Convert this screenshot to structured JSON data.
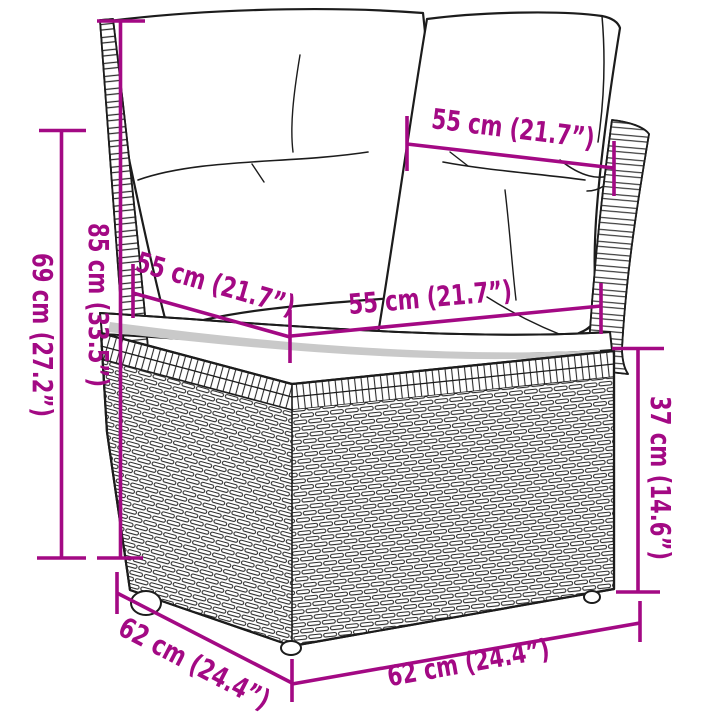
{
  "page": {
    "title": "Corner sofa with cushions — dimension diagram"
  },
  "diagram": {
    "product": "poly-rattan-corner-sofa-section-with-back-cushions",
    "accent_color": "#A30984",
    "outline_color": "#1C1C1C",
    "shadow_color": "#C9C9C9",
    "dimensions": [
      {
        "id": "back-height-with-cushions",
        "label": "85 cm (33.5”)"
      },
      {
        "id": "frame-height",
        "label": "69 cm (27.2”)"
      },
      {
        "id": "back-cushion-width",
        "label": "55 cm (21.7”)"
      },
      {
        "id": "seat-depth",
        "label": "55 cm (21.7”)"
      },
      {
        "id": "seat-width",
        "label": "55 cm (21.7”)"
      },
      {
        "id": "seat-height",
        "label": "37 cm (14.6”)"
      },
      {
        "id": "base-depth",
        "label": "62 cm (24.4”)"
      },
      {
        "id": "base-width",
        "label": "62 cm (24.4”)"
      }
    ]
  }
}
